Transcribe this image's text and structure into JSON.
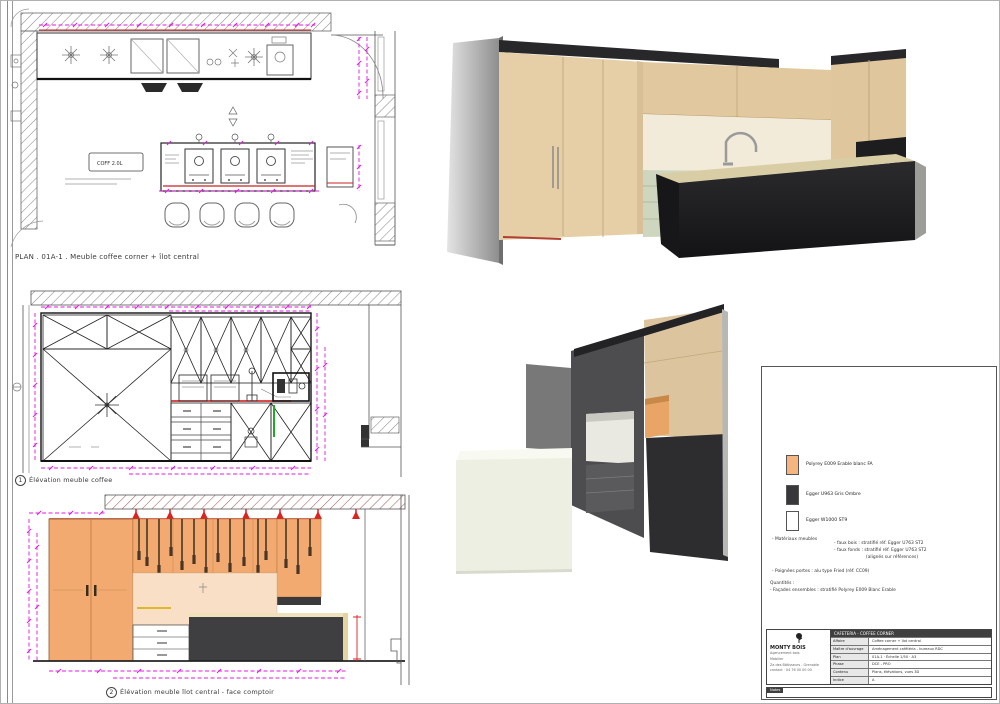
{
  "colors": {
    "dim_magenta": "#e318e3",
    "accent_red": "#cc2222",
    "cabinet_orange": "#f2aa70",
    "island_dark": "#3f3f41",
    "render_beige": "#e4cda4",
    "drawer_sage": "#cfd6c0"
  },
  "captions": {
    "plan": "PLAN .  01A-1 .  Meuble coffee corner + îlot central",
    "elev1_num": "1",
    "elev1": "Élévation meuble coffee",
    "elev2_num": "2",
    "elev2": "Élévation meuble îlot central - face comptoir"
  },
  "plan": {
    "equipment_label": "COFF 2.0L"
  },
  "legend": {
    "items": [
      {
        "label": "Polyrey E009 Erable blanc FA",
        "color": "#f5b57f"
      },
      {
        "label": "Egger U963 Gris Ombre",
        "color": "#38383a"
      },
      {
        "label": "Egger W1000 ST9",
        "color": "#ffffff"
      }
    ],
    "section_label": "- Matériaux meubles",
    "notes_right": [
      "- faux bois : stratifié réf. Egger U763 ST2",
      "- faux fonds : stratifié réf. Egger U763 ST2",
      "(alignés sur références)"
    ],
    "note_handles": "- Poignées portes : alu type Fried (réf. CC09)",
    "note_qty_title": "Quantités :",
    "note_qty": "- Façades ensembles : stratifié Polyrey E009 Blanc Erable"
  },
  "titleblock": {
    "company": "MONTY BOIS",
    "address_lines": [
      "Agencement bois",
      "Mobilier",
      "Za des Bâtisseurs - Grenoble",
      "contact · 04 76 00 00 00"
    ],
    "table_header": "CAFETERIA  -  COFFEE CORNER",
    "rows": [
      {
        "label": "Affaire",
        "value": "Coffee corner + îlot central"
      },
      {
        "label": "Maître d'ouvrage",
        "value": "Aménagement cafétéria - bureaux RDC"
      },
      {
        "label": "Plan",
        "value": "01A-1   ·   Échelle 1/50   ·   A3"
      },
      {
        "label": "Phase",
        "value": "DCE - PRO"
      },
      {
        "label": "Contenu",
        "value": "Plans, élévations, vues 3D"
      },
      {
        "label": "Indice",
        "value": "A"
      }
    ],
    "bottom_label": "Notes"
  }
}
